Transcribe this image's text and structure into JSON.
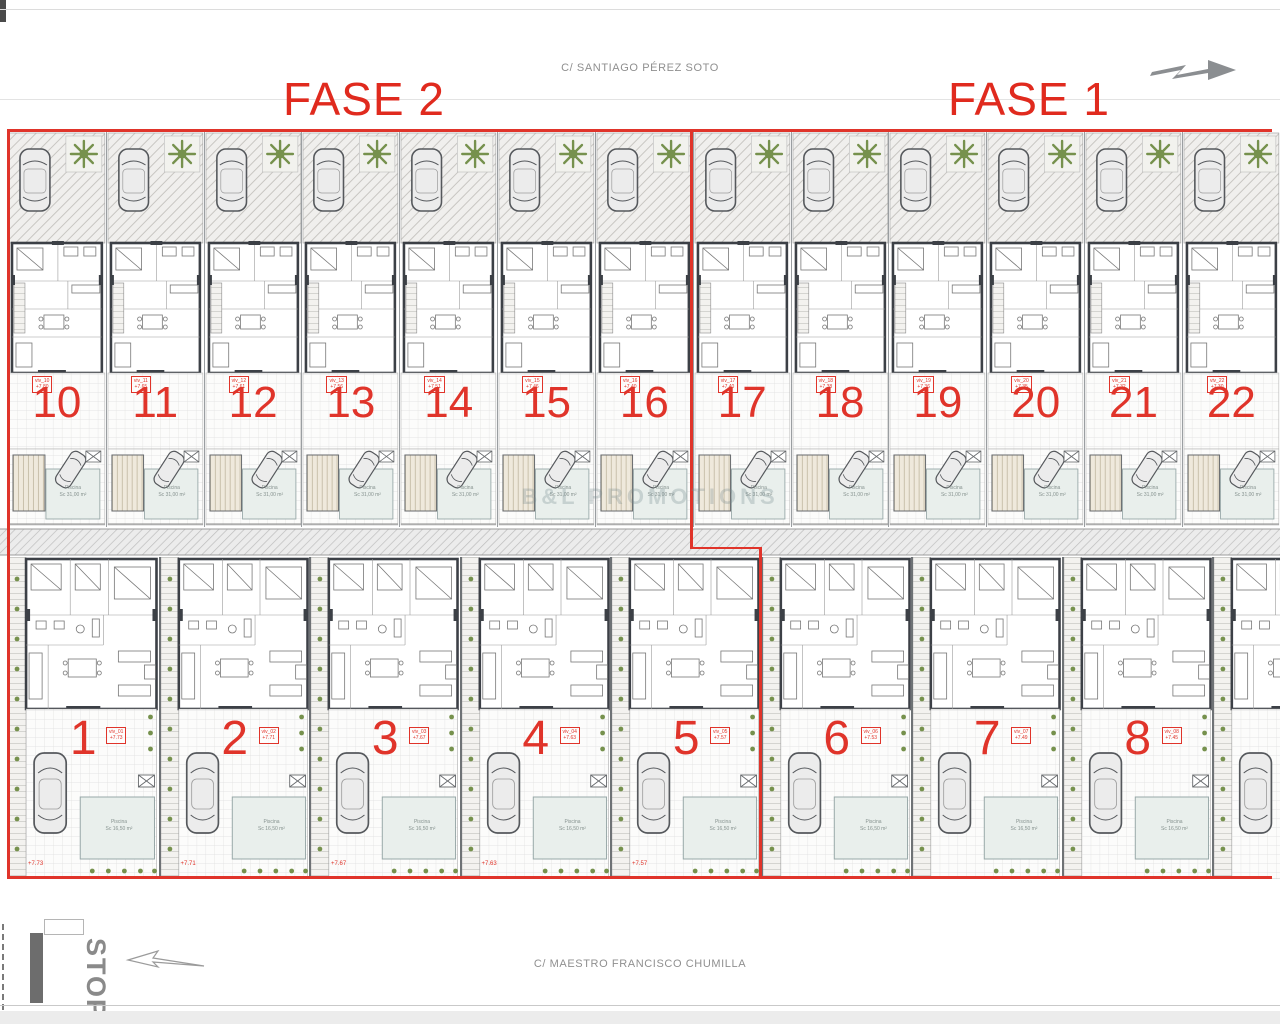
{
  "streets": {
    "top": "C/ SANTIAGO PÉREZ SOTO",
    "bottom": "C/ MAESTRO FRANCISCO CHUMILLA"
  },
  "phase_labels": {
    "fase2": "FASE 2",
    "fase1": "FASE 1"
  },
  "watermark": "B&L PROMOTIONS",
  "road_sign": "STOP",
  "icons": {
    "north_arrow": "direction-arrow",
    "road_arrow": "lane-marking-arrow",
    "tree": "garden-tree",
    "car": "parked-car",
    "pool_cross_box": "pergola-symbol"
  },
  "colors": {
    "phase_red": "#e0342a",
    "wall_dark": "#3c4046",
    "plan_gray": "#9a9a9a",
    "green": "#76914d",
    "pool": "#e9efec"
  },
  "top_row": {
    "pool_name": "Piscina",
    "pool_area": "Sc 31,00 m²",
    "units": [
      {
        "num": "10",
        "tag": "viv_10",
        "level": "+7.80"
      },
      {
        "num": "11",
        "tag": "viv_11",
        "level": "+7.65"
      },
      {
        "num": "12",
        "tag": "viv_12",
        "level": "+7.61"
      },
      {
        "num": "13",
        "tag": "viv_13",
        "level": "+7.56"
      },
      {
        "num": "14",
        "tag": "viv_14",
        "level": "+7.51"
      },
      {
        "num": "15",
        "tag": "viv_15",
        "level": "+7.46"
      },
      {
        "num": "16",
        "tag": "viv_16",
        "level": "+7.40"
      },
      {
        "num": "17",
        "tag": "viv_17",
        "level": "+7.40"
      },
      {
        "num": "18",
        "tag": "viv_18",
        "level": "+7.38"
      },
      {
        "num": "19",
        "tag": "viv_19",
        "level": "+7.36"
      },
      {
        "num": "20",
        "tag": "viv_20",
        "level": "+7.35"
      },
      {
        "num": "21",
        "tag": "viv_21",
        "level": "+7.32"
      },
      {
        "num": "22",
        "tag": "viv_22",
        "level": "+7.30"
      }
    ]
  },
  "bottom_row": {
    "pool_name": "Piscina",
    "pool_area": "Sc 16,50 m²",
    "units": [
      {
        "num": "1",
        "tag": "viv_01",
        "level": "+7.73",
        "elev": "+7.73"
      },
      {
        "num": "2",
        "tag": "viv_02",
        "level": "+7.71",
        "elev": "+7.71"
      },
      {
        "num": "3",
        "tag": "viv_03",
        "level": "+7.67",
        "elev": "+7.67"
      },
      {
        "num": "4",
        "tag": "viv_04",
        "level": "+7.63",
        "elev": "+7.63"
      },
      {
        "num": "5",
        "tag": "viv_05",
        "level": "+7.57",
        "elev": "+7.57"
      },
      {
        "num": "6",
        "tag": "viv_06",
        "level": "+7.53",
        "elev": ""
      },
      {
        "num": "7",
        "tag": "viv_07",
        "level": "+7.49",
        "elev": ""
      },
      {
        "num": "8",
        "tag": "viv_08",
        "level": "+7.45",
        "elev": ""
      },
      {
        "num": "",
        "tag": "",
        "level": "",
        "elev": ""
      }
    ]
  }
}
